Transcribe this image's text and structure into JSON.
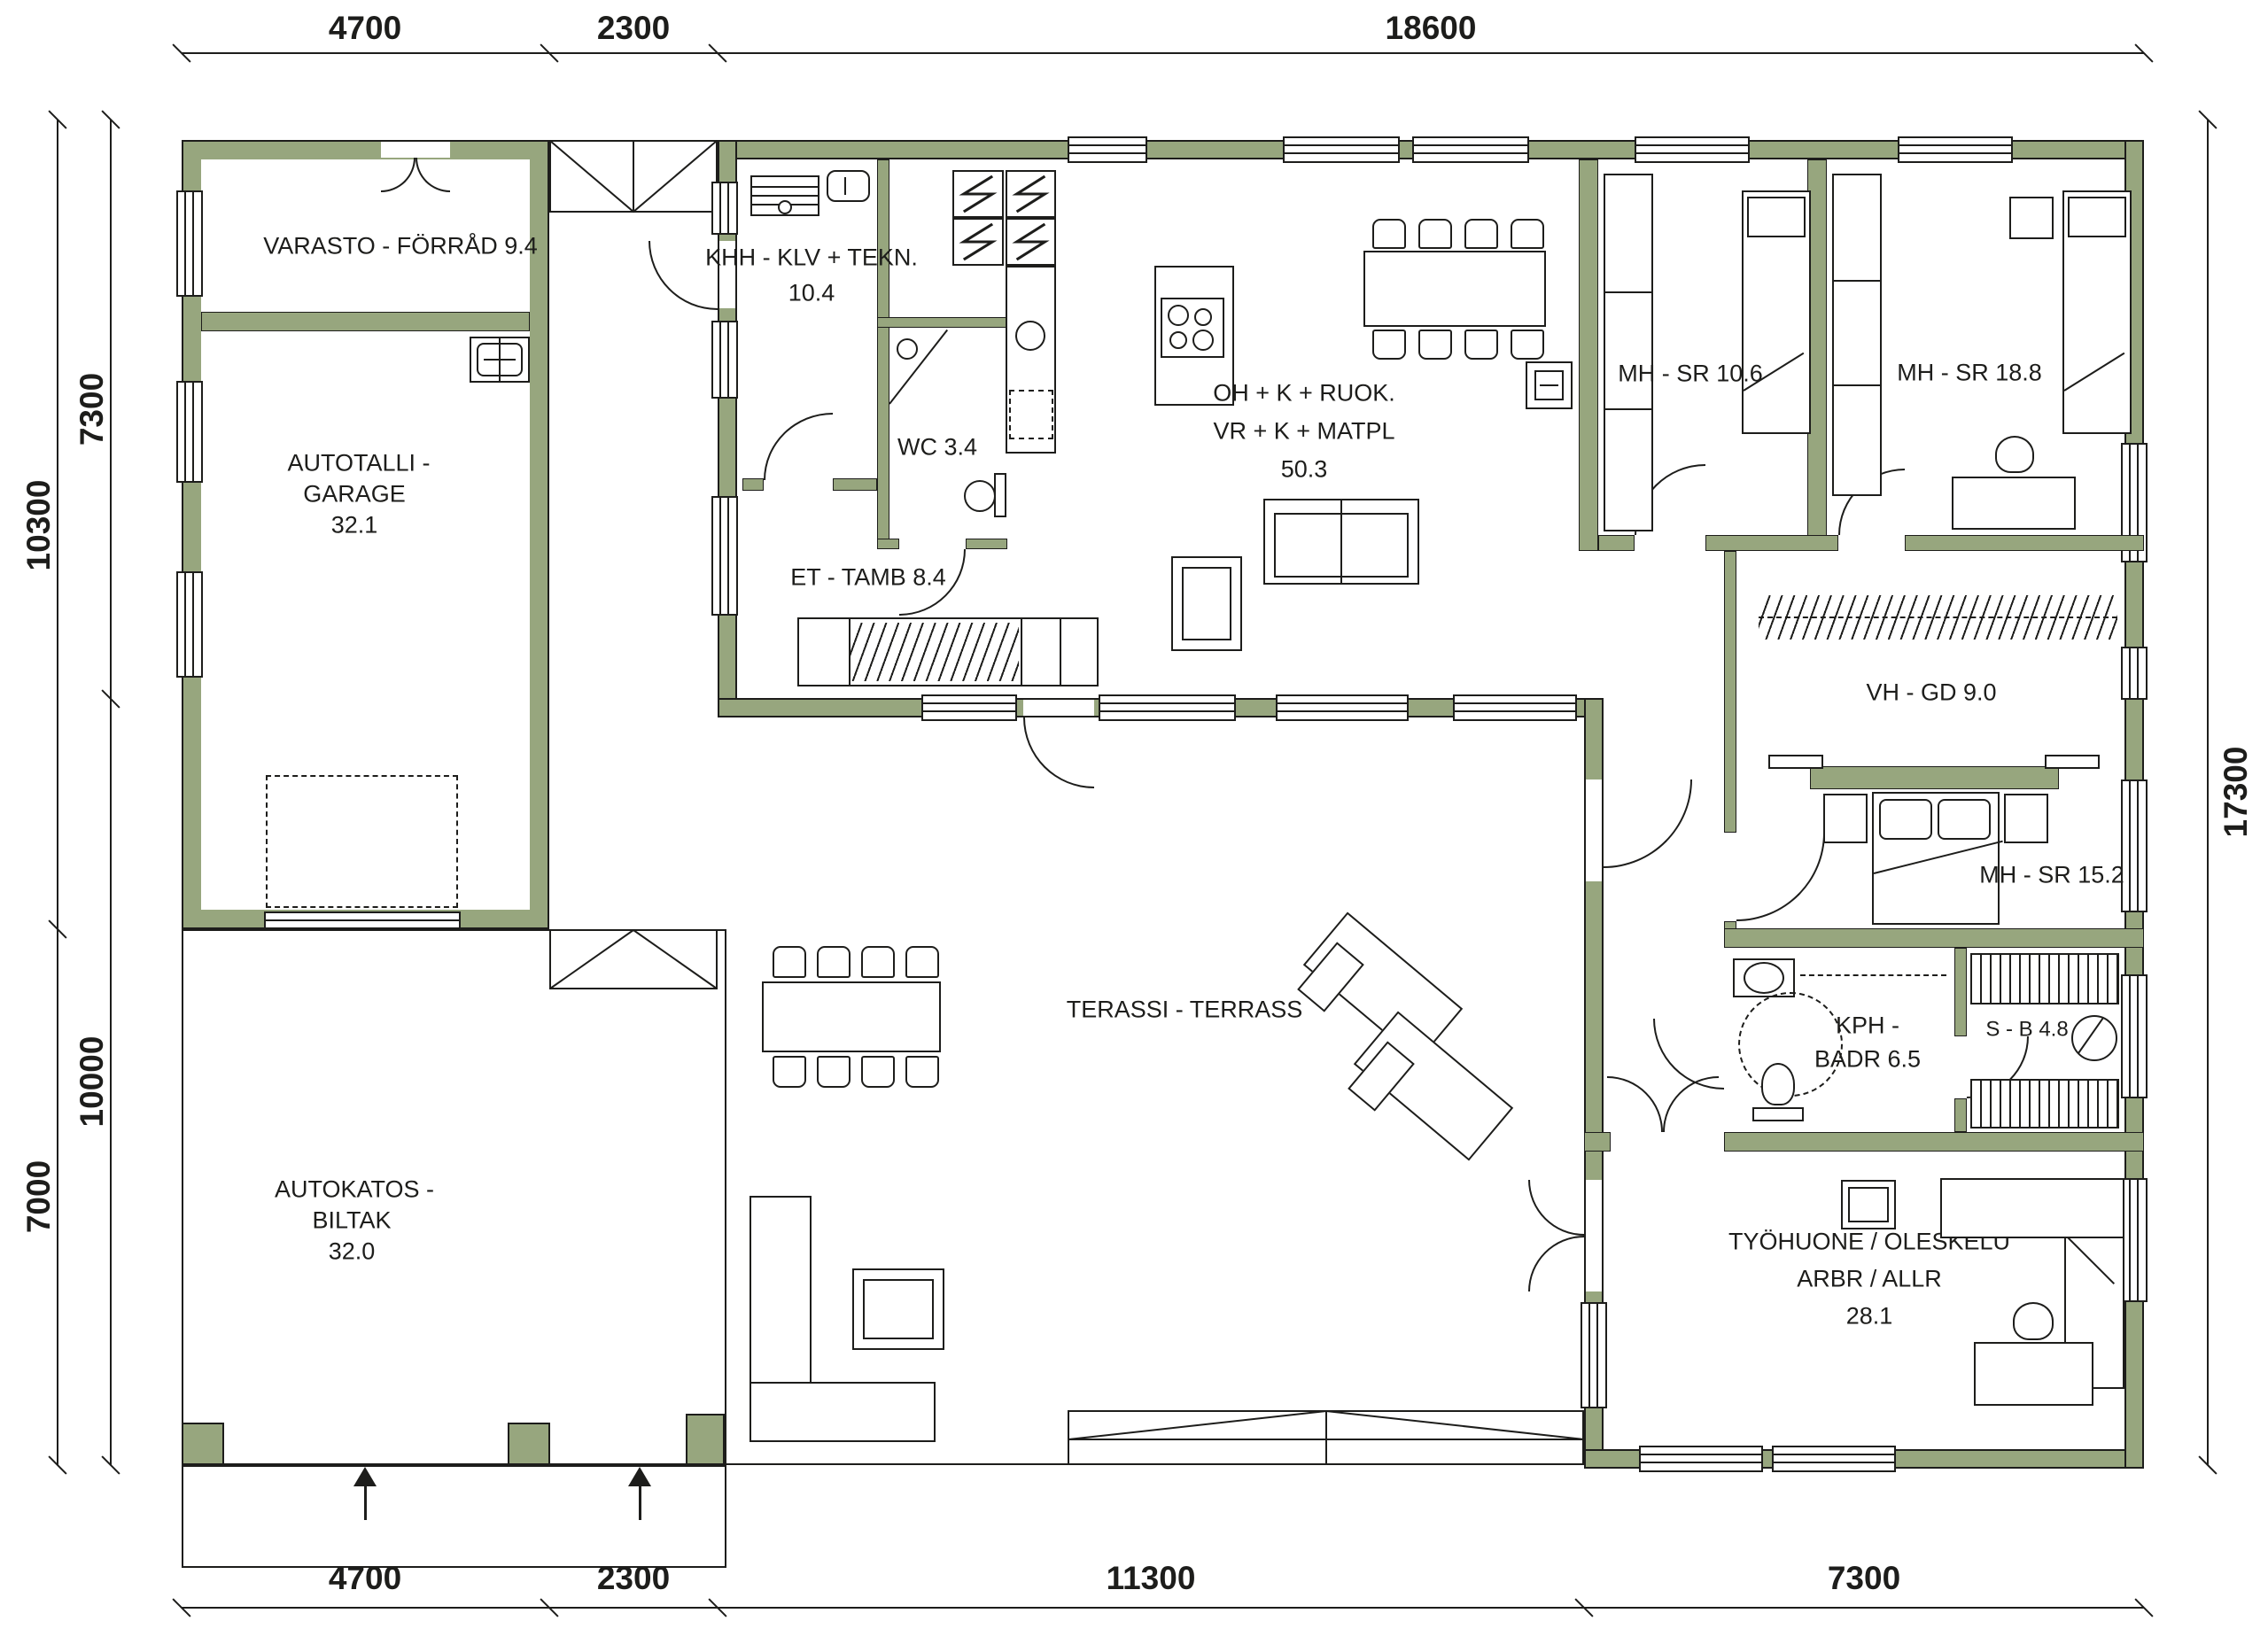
{
  "drawing": {
    "type": "architectural floor plan",
    "colors": {
      "wall_fill": "#97a67e",
      "line": "#1d1d1b",
      "background": "#ffffff"
    }
  },
  "rooms": {
    "varasto": {
      "name": "VARASTO - FÖRRÅD 9.4"
    },
    "garage": {
      "line1": "AUTOTALLI -",
      "line2": "GARAGE",
      "area": "32.1"
    },
    "khh": {
      "name": "KHH - KLV + TEKN.",
      "area": "10.4"
    },
    "wc": {
      "name": "WC 3.4"
    },
    "et": {
      "name": "ET - TAMB 8.4"
    },
    "living": {
      "line1": "OH + K + RUOK.",
      "line2": "VR + K + MATPL",
      "area": "50.3"
    },
    "mh106": {
      "name": "MH - SR 10.6"
    },
    "mh188": {
      "name": "MH - SR 18.8"
    },
    "vhgd": {
      "name": "VH - GD 9.0"
    },
    "mh152": {
      "name": "MH - SR 15.2"
    },
    "kph": {
      "line1": "KPH -",
      "line2": "BADR 6.5"
    },
    "sauna": {
      "name": "S - B 4.8"
    },
    "terrace": {
      "name": "TERASSI - TERRASS"
    },
    "carport": {
      "line1": "AUTOKATOS -",
      "line2": "BILTAK",
      "area": "32.0"
    },
    "tyohuone": {
      "line1": "TYÖHUONE / OLESKELU",
      "line2": "ARBR / ALLR",
      "area": "28.1"
    }
  },
  "dimensions": {
    "top": [
      {
        "value": "4700"
      },
      {
        "value": "2300"
      },
      {
        "value": "18600"
      }
    ],
    "bottom": [
      {
        "value": "4700"
      },
      {
        "value": "2300"
      },
      {
        "value": "11300"
      },
      {
        "value": "7300"
      }
    ],
    "left_outer": [
      {
        "value": "10300"
      },
      {
        "value": "7000"
      }
    ],
    "left_inner": [
      {
        "value": "7300"
      },
      {
        "value": "10000"
      }
    ],
    "right": [
      {
        "value": "17300"
      }
    ]
  }
}
